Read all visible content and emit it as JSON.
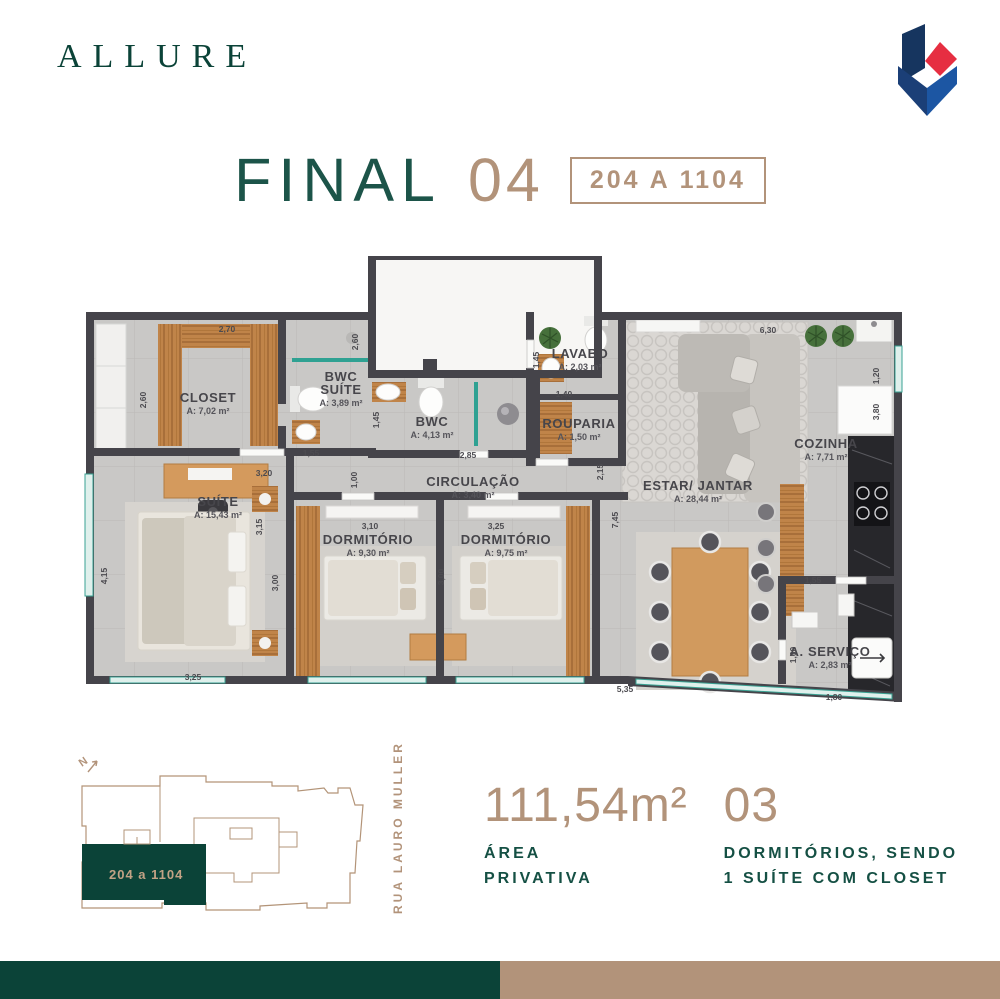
{
  "brand": {
    "logo_text": "ALLURE"
  },
  "title": {
    "final_label": "FINAL",
    "final_number": "04",
    "units_range": "204 A 1104"
  },
  "colors": {
    "brand_green": "#0b4338",
    "accent_tan": "#b2937a",
    "plan_wall": "#45444a",
    "window_teal": "#2fa192"
  },
  "floor_plan": {
    "rooms": [
      {
        "name": [
          "CLOSET"
        ],
        "area": "A: 7,02 m²",
        "x": 128,
        "y": 152
      },
      {
        "name": [
          "BWC",
          "SUÍTE"
        ],
        "area": "A: 3,89 m²",
        "x": 261,
        "y": 131
      },
      {
        "name": [
          "BWC"
        ],
        "area": "A: 4,13 m²",
        "x": 352,
        "y": 176
      },
      {
        "name": [
          "LAVABO"
        ],
        "area": "A: 2,03 m²",
        "x": 500,
        "y": 108
      },
      {
        "name": [
          "ROUPARIA"
        ],
        "area": "A: 1,50 m²",
        "x": 499,
        "y": 178
      },
      {
        "name": [
          "CIRCULAÇÃO"
        ],
        "area": "A: 3,40 m²",
        "x": 393,
        "y": 236
      },
      {
        "name": [
          "SUÍTE"
        ],
        "area": "A: 15,43 m²",
        "x": 138,
        "y": 256
      },
      {
        "name": [
          "DORMITÓRIO"
        ],
        "area": "A: 9,30 m²",
        "x": 288,
        "y": 294
      },
      {
        "name": [
          "DORMITÓRIO"
        ],
        "area": "A: 9,75 m²",
        "x": 426,
        "y": 294
      },
      {
        "name": [
          "ESTAR/ JANTAR"
        ],
        "area": "A: 28,44 m²",
        "x": 618,
        "y": 240
      },
      {
        "name": [
          "COZINHA"
        ],
        "area": "A: 7,71 m²",
        "x": 746,
        "y": 198
      },
      {
        "name": [
          "A. SERVIÇO"
        ],
        "area": "A: 2,83 m²",
        "x": 750,
        "y": 406
      }
    ],
    "dimensions": [
      {
        "t": "2,70",
        "x": 147,
        "y": 82
      },
      {
        "t": "2,60",
        "x": 66,
        "y": 150,
        "r": -90
      },
      {
        "t": "2,60",
        "x": 278,
        "y": 92,
        "r": -90
      },
      {
        "t": "1,55",
        "x": 231,
        "y": 206
      },
      {
        "t": "3,20",
        "x": 184,
        "y": 226
      },
      {
        "t": "1,00",
        "x": 277,
        "y": 230,
        "r": -90
      },
      {
        "t": "1,45",
        "x": 299,
        "y": 170,
        "r": -90
      },
      {
        "t": "2,85",
        "x": 388,
        "y": 208
      },
      {
        "t": "1,45",
        "x": 459,
        "y": 110,
        "r": -90
      },
      {
        "t": "1,40",
        "x": 484,
        "y": 147
      },
      {
        "t": "2,15",
        "x": 523,
        "y": 222,
        "r": -90
      },
      {
        "t": "6,30",
        "x": 688,
        "y": 83
      },
      {
        "t": "1,20",
        "x": 799,
        "y": 126,
        "r": -90
      },
      {
        "t": "3,80",
        "x": 799,
        "y": 162,
        "r": -90
      },
      {
        "t": "4,15",
        "x": 27,
        "y": 326,
        "r": -90
      },
      {
        "t": "3,25",
        "x": 113,
        "y": 430
      },
      {
        "t": "3,15",
        "x": 182,
        "y": 277,
        "r": -90
      },
      {
        "t": "3,00",
        "x": 198,
        "y": 333,
        "r": -90
      },
      {
        "t": "3,10",
        "x": 290,
        "y": 279
      },
      {
        "t": "3,25",
        "x": 416,
        "y": 279
      },
      {
        "t": "3,00",
        "x": 364,
        "y": 327,
        "r": -90
      },
      {
        "t": "7,45",
        "x": 538,
        "y": 270,
        "r": -90
      },
      {
        "t": "1,55",
        "x": 733,
        "y": 333
      },
      {
        "t": "1,60",
        "x": 716,
        "y": 405,
        "r": -90
      },
      {
        "t": "1,80",
        "x": 754,
        "y": 450
      },
      {
        "t": "5,35",
        "x": 545,
        "y": 442
      }
    ]
  },
  "site_plan": {
    "north_label": "N",
    "highlight_label": "204 a 1104",
    "street": "RUA LAURO MULLER"
  },
  "stats": [
    {
      "value": "111,54m²",
      "label_lines": [
        "ÁREA",
        "PRIVATIVA"
      ]
    },
    {
      "value": "03",
      "label_lines": [
        "DORMITÓRIOS, SENDO",
        "1 SUÍTE COM CLOSET"
      ]
    }
  ]
}
